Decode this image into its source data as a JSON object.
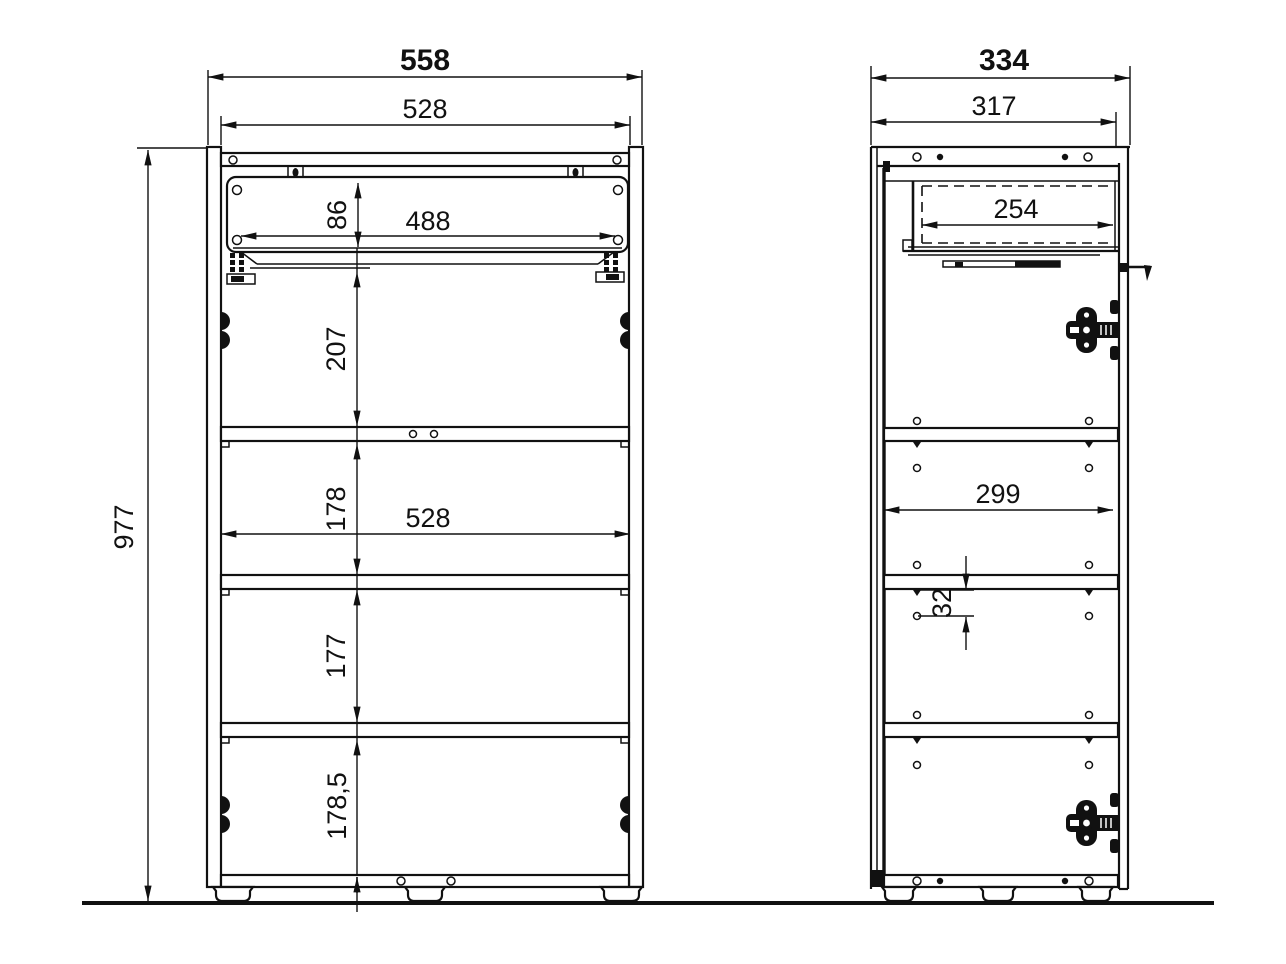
{
  "drawing": {
    "kind": "cabinet technical drawing, front and side elevations with dimensions",
    "colors": {
      "line": "#111111",
      "background": "#ffffff"
    }
  },
  "front_view": {
    "dimensions": {
      "overall_width": "558",
      "inner_width_top": "528",
      "drawer_opening_height": "86",
      "drawer_inner_width": "488",
      "top_compartment_height": "207",
      "second_compartment_height": "178",
      "inner_width_middle": "528",
      "third_compartment_height": "177",
      "bottom_compartment_height": "178,5",
      "overall_height": "977"
    }
  },
  "side_view": {
    "dimensions": {
      "overall_depth": "334",
      "depth_without_handle": "317",
      "drawer_inner_depth": "254",
      "inner_depth": "299",
      "system_hole_offset": "32"
    }
  }
}
